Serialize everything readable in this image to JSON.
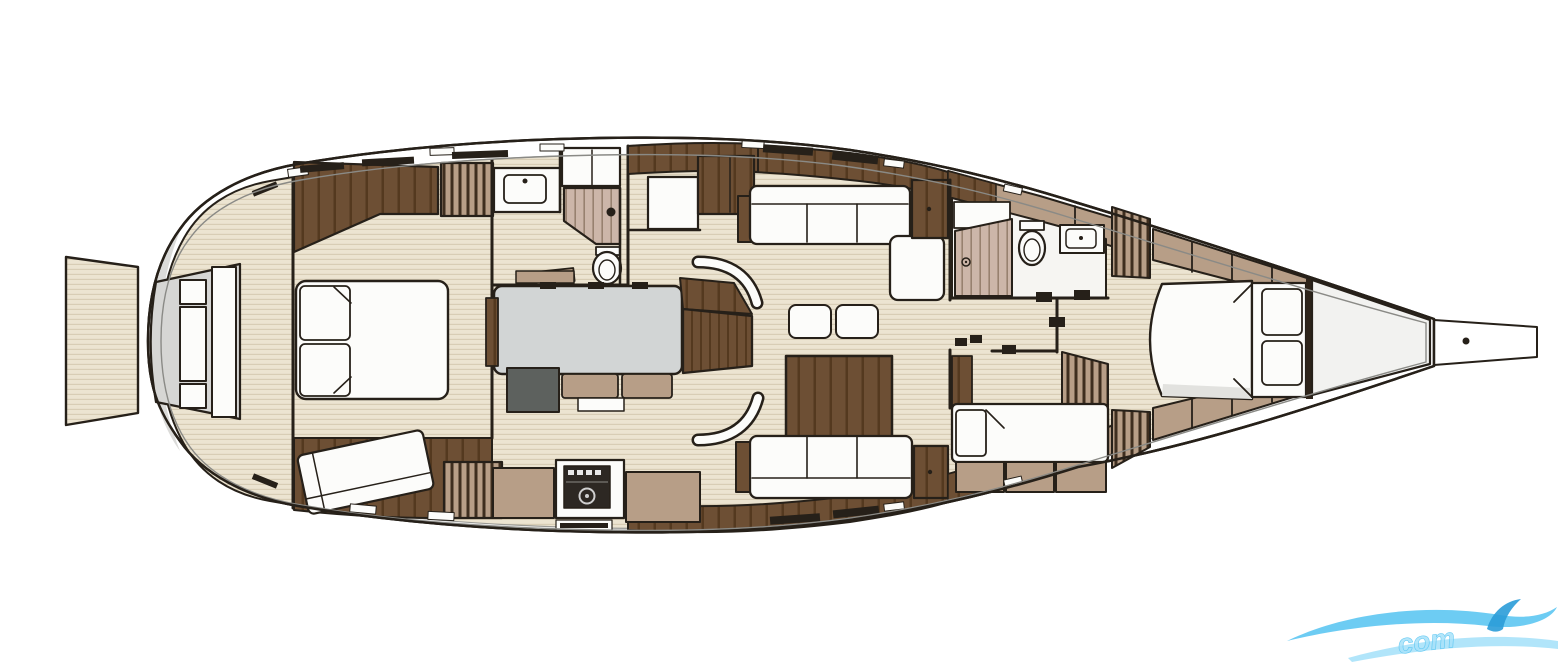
{
  "watermark": {
    "text": "com"
  },
  "colors": {
    "background": "#ffffff",
    "outline": "#262019",
    "hull-fill": "#ffffff",
    "hull-inner-line": "#8a8a86",
    "stern-shade": "#dbdbd9",
    "floor": "#ece4d1",
    "floor-line": "#d8cdb5",
    "wood": "#6d4f34",
    "wood-line": "#54391f",
    "mocha": "#b79e87",
    "slat": "#3e2e1f",
    "tread": "#ccb6a9",
    "tread-line": "#97816f",
    "white-furniture": "#fcfcfa",
    "grey-table": "#d2d5d5",
    "grey-dark": "#5d615e",
    "transom-recess": "#d6d6d4",
    "anchor-locker": "#f2f2f0",
    "head-floor": "#f6f5f2",
    "stove": "#2d2823",
    "foot-shade": "#e2e2df",
    "trim-dark": "#2e241a",
    "watermark-blue": "#53c3f1",
    "watermark-blue-light": "#a8e2fa",
    "watermark-blue-dark": "#2a9cd8"
  },
  "diagram": {
    "type": "sailing-yacht-interior-layout-plan",
    "orientation": "bow-right-stern-left",
    "features": [
      "swim-platform",
      "transom-locker-recess",
      "aft-teak-deck",
      "aft-cabin-double-berth",
      "aft-cabin-wardrobe",
      "aft-cabin-chaise",
      "hanging-lockers",
      "aft-head-sink",
      "aft-head-toilet",
      "aft-staircase",
      "bunk-cabin-berth",
      "galley-island",
      "galley-stove",
      "chart-block",
      "companionway-stairs",
      "companionway-handrails",
      "salon-settee",
      "coffee-tables",
      "dining-table",
      "salon-sofa",
      "mid-head-shower",
      "mid-head-toilet",
      "mid-head-sink",
      "guest-cabin-berth",
      "forward-cabin-double-berth",
      "anchor-locker",
      "bowsprit",
      "deck-hatches",
      "deck-fittings"
    ]
  }
}
